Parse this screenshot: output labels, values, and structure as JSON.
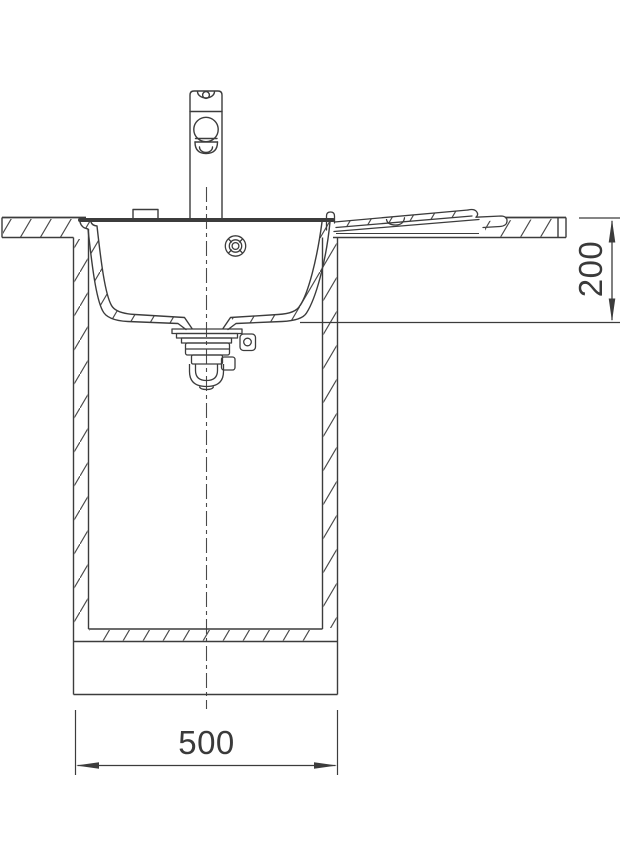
{
  "dims": {
    "depth": "200",
    "width": "500"
  },
  "colors": {
    "line": "#3c3c3c",
    "background": "#ffffff"
  }
}
